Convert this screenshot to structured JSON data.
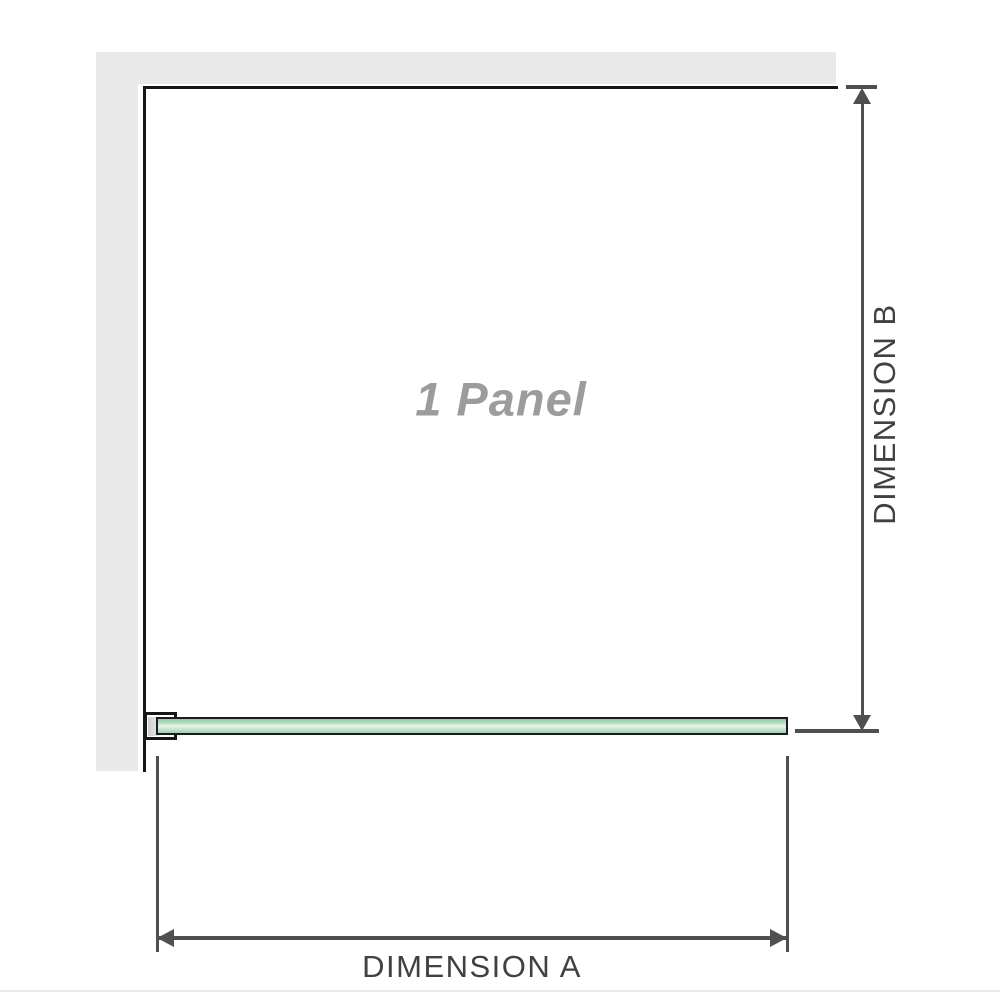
{
  "diagram": {
    "panel_label": "1 Panel",
    "dimension_a_label": "DIMENSION A",
    "dimension_b_label": "DIMENSION B"
  },
  "colors": {
    "wall": "#e9e9e9",
    "outline": "#161616",
    "glass_border": "#1c1c1c",
    "glass_green": "#9fd2b1",
    "glass_highlight": "#e9f5ee",
    "dimension": "#4f4f4f",
    "dimension_text": "#414141",
    "panel_label_gray": "#9c9c9c",
    "baseline_gray": "#e9e9e6"
  }
}
